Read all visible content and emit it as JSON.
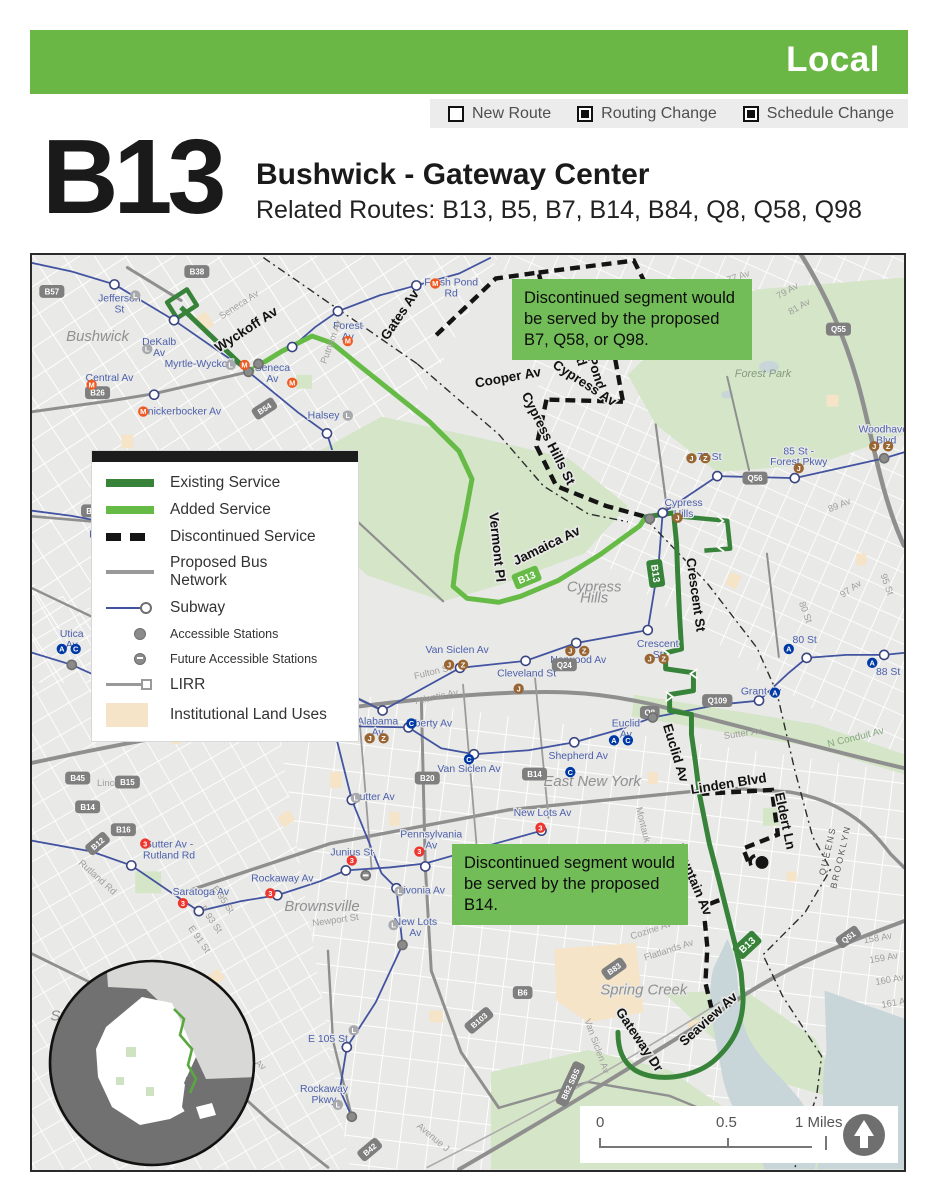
{
  "header": {
    "banner_label": "Local",
    "route_types": [
      {
        "label": "New Route"
      },
      {
        "label": "Routing Change"
      },
      {
        "label": "Schedule Change"
      }
    ]
  },
  "title": {
    "route": "B13",
    "name": "Bushwick - Gateway Center",
    "related": "Related Routes: B13, B5, B7, B14, B84, Q8, Q58, Q98"
  },
  "legend": {
    "items": [
      {
        "label": "Existing Service"
      },
      {
        "label": "Added Service"
      },
      {
        "label": "Discontinued Service"
      },
      {
        "label": "Proposed Bus Network"
      },
      {
        "label": "Subway"
      },
      {
        "label": "Accessible Stations"
      },
      {
        "label": "Future Accessible Stations"
      },
      {
        "label": "LIRR"
      },
      {
        "label": "Institutional Land Uses"
      }
    ]
  },
  "callouts": [
    {
      "text": "Discontinued segment would be served by the proposed B7, Q58, or Q98."
    },
    {
      "text": "Discontinued segment would be served by the proposed B14."
    }
  ],
  "scalebar": {
    "labels": [
      "0",
      "0.5",
      "1 Miles"
    ]
  },
  "colors": {
    "banner": "#6bb745",
    "callout": "#72bd57",
    "existing": "#38833a",
    "added": "#66bb46",
    "discontinued": "#141414",
    "proposed": "#8f8f8f",
    "subway": "#4253a0",
    "station_label": "#4c60ac",
    "park": "#d5e5c8",
    "water": "#c9d6d9",
    "institutional": "#f5e4c8",
    "badge": "#7f7f7f",
    "lines": {
      "M": "#f05a22",
      "J": "#996633",
      "Z": "#996633",
      "A": "#0039a6",
      "C": "#0039a6",
      "L": "#a7a9ac",
      "3": "#ee352e"
    }
  },
  "map": {
    "labels": {
      "route": [
        [
          "Wyckoff Av",
          218,
          78,
          -33
        ],
        [
          "Gates Av",
          374,
          62,
          -56
        ],
        [
          "Fresh Pond|Rd",
          558,
          100,
          72
        ],
        [
          "Cooper Av",
          480,
          127,
          -10
        ],
        [
          "Cypress Hills St",
          516,
          186,
          63
        ],
        [
          "Cypress Av",
          554,
          132,
          33
        ],
        [
          "Vermont Pl",
          464,
          294,
          84
        ],
        [
          "Jamaica Av",
          520,
          296,
          -26
        ],
        [
          "Crescent St",
          664,
          342,
          82
        ],
        [
          "Euclid Av",
          644,
          502,
          73
        ],
        [
          "Linden Blvd",
          702,
          536,
          -9
        ],
        [
          "Eldert Ln",
          754,
          570,
          78
        ],
        [
          "Fountain Av",
          662,
          630,
          67
        ],
        [
          "Gateway Dr",
          608,
          792,
          56
        ],
        [
          "Seaview Av",
          684,
          772,
          -42
        ]
      ],
      "station": [
        [
          "Jefferson|St",
          88,
          46,
          0
        ],
        [
          "DeKalb|Av",
          128,
          90,
          0
        ],
        [
          "Central Av",
          78,
          126,
          0
        ],
        [
          "Knickerbocker Av",
          150,
          160,
          0
        ],
        [
          "Myrtle-Wyckoff",
          168,
          112,
          0
        ],
        [
          "Kosciuszko|St",
          84,
          284,
          0
        ],
        [
          "Utica|Av",
          40,
          384,
          0
        ],
        [
          "Seneca|Av",
          242,
          116,
          0
        ],
        [
          "Forest|Av",
          318,
          74,
          0
        ],
        [
          "Fresh Pond|Rd",
          422,
          30,
          0
        ],
        [
          "Halsey St",
          300,
          164,
          0
        ],
        [
          "Cypress|Hills",
          656,
          252,
          0
        ],
        [
          "75 St",
          682,
          206,
          0
        ],
        [
          "85 St -|Forest Pkwy",
          772,
          200,
          0
        ],
        [
          "Woodhaven|Blvd",
          860,
          178,
          0
        ],
        [
          "Crescent|St",
          630,
          394,
          0
        ],
        [
          "Norwood Av",
          550,
          410,
          0
        ],
        [
          "Cleveland St",
          498,
          424,
          0
        ],
        [
          "Van Siclen Av",
          428,
          400,
          0
        ],
        [
          "Alabama|Av",
          348,
          472,
          0
        ],
        [
          "Liberty Av",
          400,
          474,
          0
        ],
        [
          "Shepherd Av",
          550,
          507,
          0
        ],
        [
          "Van Siclen Av",
          440,
          520,
          0
        ],
        [
          "Euclid|Av",
          598,
          474,
          0
        ],
        [
          "Grant Av",
          734,
          442,
          0
        ],
        [
          "80 St",
          778,
          390,
          0
        ],
        [
          "88 St",
          862,
          422,
          0
        ],
        [
          "Sutter Av",
          344,
          548,
          0
        ],
        [
          "Livonia Av",
          392,
          642,
          0
        ],
        [
          "New Lots|Av",
          386,
          674,
          0
        ],
        [
          "E 105 St",
          298,
          792,
          0
        ],
        [
          "Rockaway|Pkwy",
          294,
          842,
          0
        ],
        [
          "Sutter Av -|Rutland Rd",
          138,
          596,
          0
        ],
        [
          "Saratoga Av",
          170,
          644,
          0
        ],
        [
          "Rockaway Av",
          252,
          630,
          0
        ],
        [
          "Junius St",
          322,
          604,
          0
        ],
        [
          "Pennsylvania|Av",
          402,
          586,
          0
        ],
        [
          "New Lots Av",
          514,
          564,
          0
        ]
      ],
      "street": [
        [
          "Seneca Av",
          210,
          52,
          -33
        ],
        [
          "Putnam Av",
          304,
          88,
          -70
        ],
        [
          "Fulton St",
          404,
          422,
          -14
        ],
        [
          "Atlantic Av",
          408,
          447,
          -12
        ],
        [
          "Sutter Av",
          716,
          484,
          -8
        ],
        [
          "Lincoln Pl",
          86,
          534,
          0
        ],
        [
          "Rutland Rd",
          64,
          628,
          42
        ],
        [
          "E 95 St",
          190,
          650,
          55
        ],
        [
          "E 93 St",
          178,
          670,
          55
        ],
        [
          "E 91 St",
          166,
          690,
          55
        ],
        [
          "Newport St",
          306,
          672,
          -8
        ],
        [
          "89 Av",
          814,
          254,
          -22
        ],
        [
          "97 Av",
          826,
          338,
          -35
        ],
        [
          "80 St",
          776,
          360,
          70
        ],
        [
          "95 St",
          858,
          332,
          70
        ],
        [
          "77 Av",
          712,
          24,
          -18
        ],
        [
          "79 Av",
          762,
          38,
          -30
        ],
        [
          "81 Av",
          774,
          54,
          -30
        ],
        [
          "Cozine Av",
          624,
          682,
          -18
        ],
        [
          "Flatlands Av",
          642,
          702,
          -18
        ],
        [
          "Van Siclen Av",
          566,
          797,
          70
        ],
        [
          "Ditmas Av",
          216,
          807,
          40
        ],
        [
          "Avenue J",
          402,
          890,
          40
        ],
        [
          "158 Av",
          852,
          690,
          -10
        ],
        [
          "159 Av",
          858,
          710,
          -10
        ],
        [
          "160 Av",
          864,
          732,
          -10
        ],
        [
          "161 Av",
          870,
          755,
          -10
        ],
        [
          "Montauk Av",
          614,
          580,
          76
        ]
      ],
      "hood": [
        [
          "Bushwick",
          66,
          86,
          0
        ],
        [
          "Cypress|Hills",
          566,
          338,
          0
        ],
        [
          "East New York",
          564,
          534,
          0
        ],
        [
          "Brownsville",
          292,
          660,
          0
        ],
        [
          "Starrett City",
          58,
          770,
          0
        ],
        [
          "Spring Creek",
          616,
          744,
          0
        ]
      ],
      "park": [
        [
          "Forest Park",
          736,
          122,
          0
        ],
        [
          "Cemetery of the|Evergreens",
          280,
          276,
          0
        ]
      ],
      "parkway": [
        [
          "N Conduit Av",
          830,
          488,
          -14
        ]
      ],
      "boundary": [
        [
          "QUEENS",
          804,
          600,
          -77
        ],
        [
          "BROOKLYN",
          817,
          606,
          -77
        ]
      ]
    },
    "badges": [
      [
        "B57",
        20,
        36,
        0
      ],
      [
        "B38",
        166,
        16,
        0
      ],
      [
        "B26",
        66,
        138,
        0
      ],
      [
        "B54",
        234,
        154,
        -33
      ],
      [
        "B52",
        62,
        257,
        0
      ],
      [
        "B52",
        132,
        244,
        0
      ],
      [
        "B45",
        46,
        526,
        0
      ],
      [
        "B15",
        96,
        530,
        0
      ],
      [
        "B14",
        56,
        555,
        0
      ],
      [
        "B16",
        92,
        578,
        0
      ],
      [
        "B12",
        66,
        592,
        -40
      ],
      [
        "B20",
        398,
        526,
        0
      ],
      [
        "B14",
        506,
        522,
        0
      ],
      [
        "Q24",
        536,
        412,
        0
      ],
      [
        "Q8",
        622,
        460,
        0
      ],
      [
        "Q109",
        690,
        448,
        0
      ],
      [
        "Q56",
        728,
        224,
        0
      ],
      [
        "Q55",
        812,
        74,
        0
      ],
      [
        "Q51",
        822,
        686,
        -35
      ],
      [
        "B83",
        586,
        718,
        -35
      ],
      [
        "B82 SBS",
        542,
        834,
        -65
      ],
      [
        "B42",
        340,
        900,
        -40
      ],
      [
        "B6",
        494,
        742,
        0
      ],
      [
        "B103",
        450,
        770,
        -40
      ],
      [
        "B17",
        198,
        847,
        -45
      ]
    ],
    "shields": [
      [
        "B13",
        498,
        324,
        -22,
        "added"
      ],
      [
        "B13",
        628,
        320,
        82,
        "existing"
      ],
      [
        "B13",
        720,
        694,
        -43,
        "existing"
      ]
    ],
    "stations": [
      [
        83,
        29,
        "r"
      ],
      [
        143,
        65,
        "r"
      ],
      [
        123,
        140,
        "r"
      ],
      [
        297,
        179,
        "r"
      ],
      [
        218,
        117,
        "a"
      ],
      [
        228,
        109,
        "a"
      ],
      [
        262,
        92,
        "r"
      ],
      [
        308,
        56,
        "r"
      ],
      [
        387,
        30,
        "r"
      ],
      [
        77,
        269,
        "r"
      ],
      [
        40,
        412,
        "a"
      ],
      [
        635,
        259,
        "r"
      ],
      [
        690,
        222,
        "r"
      ],
      [
        768,
        224,
        "r"
      ],
      [
        858,
        204,
        "a"
      ],
      [
        620,
        377,
        "r"
      ],
      [
        548,
        390,
        "r"
      ],
      [
        497,
        408,
        "r"
      ],
      [
        431,
        415,
        "r"
      ],
      [
        353,
        458,
        "r"
      ],
      [
        379,
        475,
        "r"
      ],
      [
        445,
        502,
        "r"
      ],
      [
        546,
        490,
        "r"
      ],
      [
        625,
        465,
        "a"
      ],
      [
        732,
        448,
        "r"
      ],
      [
        780,
        405,
        "r"
      ],
      [
        858,
        402,
        "r"
      ],
      [
        322,
        548,
        "r"
      ],
      [
        367,
        637,
        "r"
      ],
      [
        373,
        694,
        "a"
      ],
      [
        317,
        797,
        "r"
      ],
      [
        322,
        867,
        "a"
      ],
      [
        100,
        614,
        "r"
      ],
      [
        168,
        660,
        "r"
      ],
      [
        247,
        644,
        "r"
      ],
      [
        316,
        619,
        "r"
      ],
      [
        336,
        624,
        "f"
      ],
      [
        396,
        615,
        "r"
      ],
      [
        513,
        579,
        "r"
      ],
      [
        622,
        265,
        "a"
      ]
    ],
    "bullets": [
      [
        "L",
        104,
        40
      ],
      [
        "L",
        116,
        94
      ],
      [
        "M",
        60,
        130
      ],
      [
        "M",
        112,
        157
      ],
      [
        "L",
        200,
        110
      ],
      [
        "M",
        214,
        110
      ],
      [
        "J",
        66,
        272
      ],
      [
        "A",
        30,
        396
      ],
      [
        "C",
        44,
        396
      ],
      [
        "M",
        262,
        128
      ],
      [
        "M",
        318,
        86
      ],
      [
        "M",
        406,
        28
      ],
      [
        "L",
        318,
        161
      ],
      [
        "J",
        650,
        264
      ],
      [
        "J",
        664,
        204
      ],
      [
        "Z",
        678,
        204
      ],
      [
        "J",
        772,
        214
      ],
      [
        "J",
        848,
        192
      ],
      [
        "Z",
        862,
        192
      ],
      [
        "J",
        622,
        406
      ],
      [
        "Z",
        636,
        406
      ],
      [
        "J",
        542,
        398
      ],
      [
        "Z",
        556,
        398
      ],
      [
        "J",
        490,
        436
      ],
      [
        "J",
        420,
        412
      ],
      [
        "Z",
        434,
        412
      ],
      [
        "J",
        340,
        486
      ],
      [
        "Z",
        354,
        486
      ],
      [
        "C",
        382,
        471
      ],
      [
        "C",
        542,
        520
      ],
      [
        "C",
        440,
        507
      ],
      [
        "A",
        586,
        488
      ],
      [
        "C",
        600,
        488
      ],
      [
        "A",
        748,
        440
      ],
      [
        "A",
        762,
        396
      ],
      [
        "A",
        846,
        410
      ],
      [
        "L",
        326,
        546
      ],
      [
        "L",
        370,
        640
      ],
      [
        "L",
        364,
        674
      ],
      [
        "L",
        324,
        780
      ],
      [
        "L",
        308,
        855
      ],
      [
        "3",
        114,
        592
      ],
      [
        "3",
        152,
        652
      ],
      [
        "3",
        240,
        642
      ],
      [
        "3",
        322,
        609
      ],
      [
        "3",
        390,
        600
      ],
      [
        "3",
        512,
        576
      ]
    ]
  }
}
